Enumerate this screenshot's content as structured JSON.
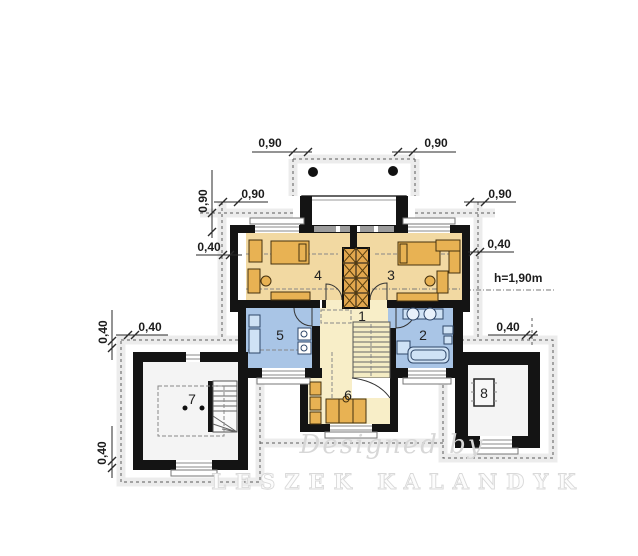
{
  "plan": {
    "rooms": {
      "r1": "1",
      "r2": "2",
      "r3": "3",
      "r4": "4",
      "r5": "5",
      "r6": "6",
      "r7": "7",
      "r8": "8"
    },
    "dimensions": {
      "balcony_left": "0,90",
      "balcony_right": "0,90",
      "upper_left_vertical": "0,90",
      "upper_left_horizontal": "0,90",
      "eave_left": "0,40",
      "right_upper": "0,90",
      "eave_right": "0,40",
      "attic_height": "h=1,90m",
      "eave_right_lower": "0,40",
      "west_vertical": "0,40",
      "west_horizontal": "0,40",
      "southwest_vertical": "0,40"
    },
    "watermark": {
      "line1": "Designed by",
      "line2": "LESZEK KALANDYK"
    },
    "colors": {
      "wall": "#141414",
      "room_tan": "#f2d9a2",
      "room_blue": "#a9c5e6",
      "room_pale_yellow": "#f8eec8",
      "furniture_orange": "#e8b253",
      "fixture_blue": "#cfe2f5",
      "chimney_orange": "#e2a74e",
      "dash_gray": "#5a5a5a"
    }
  }
}
